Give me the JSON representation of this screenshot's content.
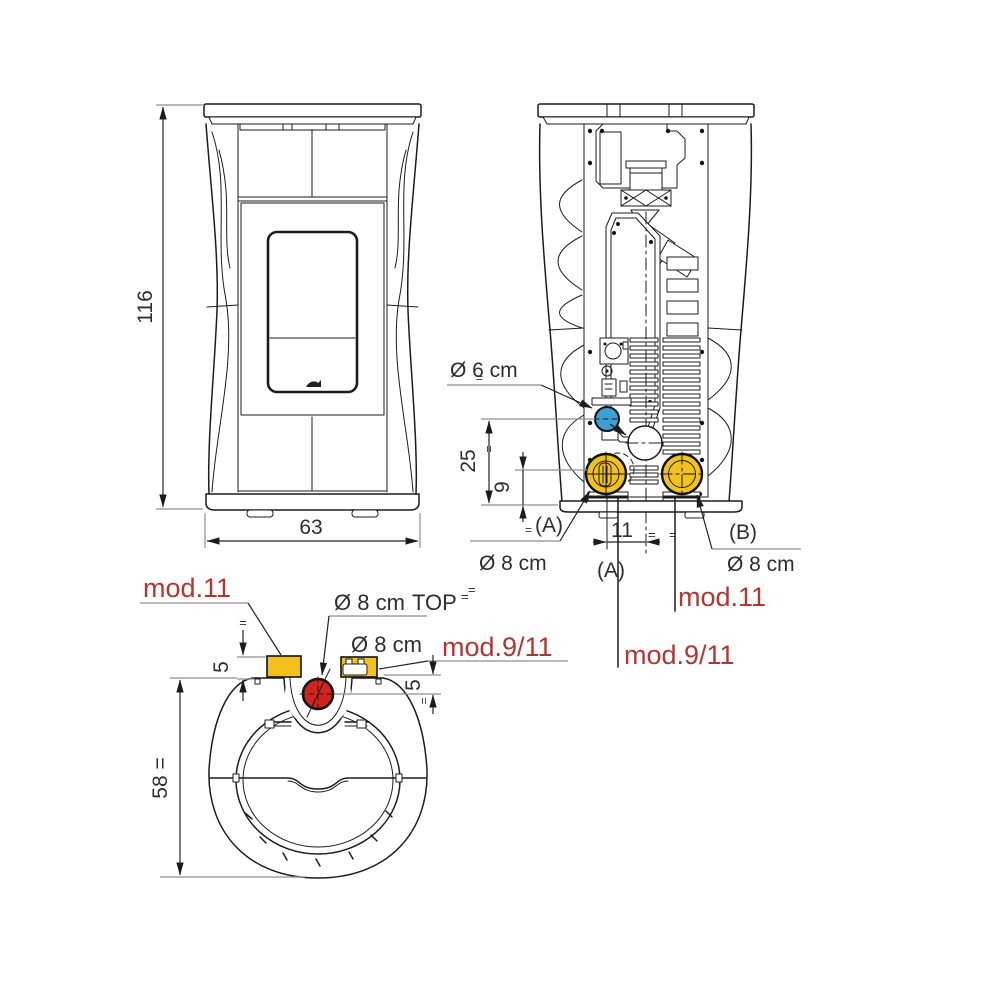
{
  "colors": {
    "line": "#1c1c1c",
    "leader_gray": "#8f8f8f",
    "label_red": "#b13632",
    "port_blue": "#3d9fd3",
    "port_yellow": "#f2c11d",
    "port_red": "#d3231f"
  },
  "front": {
    "dim_height": "116",
    "dim_width": "63"
  },
  "rear": {
    "intake_label": "Ø 6 cm",
    "intake_eq": "=",
    "dim_intake": "25",
    "dim_intake_eq": "=",
    "dim_outlet": "9",
    "eq_base": "=",
    "ref_a": "(A)",
    "eq_a": "=",
    "dia_a": "Ø 8 cm",
    "ref_b": "(B)",
    "dia_b": "Ø 8 cm",
    "dim_offset": "11",
    "eq1": "=",
    "eq2": "=",
    "ref_a2": "(A)",
    "model_center": "mod.11",
    "model_a": "mod.9/11"
  },
  "top": {
    "model_left": "mod.11",
    "dia_top": "Ø 8 cm",
    "tag_top": "TOP",
    "eq_top": "=",
    "dia_rear": "Ø 8 cm",
    "model_right": "mod.9/11",
    "dim_left": "5",
    "eq_left": "=",
    "dim_right": "5",
    "eq_right": "=",
    "dim_depth": "58 ="
  }
}
